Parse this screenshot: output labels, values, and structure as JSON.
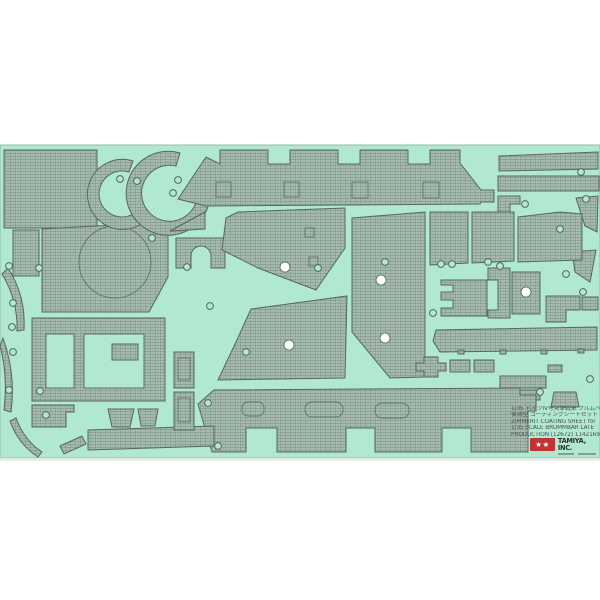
{
  "label": {
    "lines": [
      "1/35 ドイツIV号突撃戦車 ブルムベア",
      "後期型 コーティングシートセット",
      "ZIMMERIT COATING SHEET for",
      "1/35 SCALE BRUMMBAR LATE",
      "PRODUCTION (12672) 1142169"
    ]
  },
  "brand": {
    "name": "TAMIYA, INC.",
    "stars": "★★"
  },
  "colors": {
    "background": "#ffffff",
    "sheet": "#b0e8d2",
    "sheet_edge": "#8fbcaa",
    "sheet_shadow": "#dfeae4",
    "piece_base": "#a7bdaf",
    "texture_line": "#5e7366",
    "piece_stroke": "#57675c",
    "logo_red": "#c23431",
    "label_text": "#4a544e"
  },
  "sheet": {
    "x": 0,
    "y": 145,
    "w": 600,
    "h": 313,
    "pieces": [
      {
        "t": "rect",
        "x": 4,
        "y": 150,
        "w": 93,
        "h": 78,
        "name": "panel-large-left"
      },
      {
        "t": "rect",
        "x": 13,
        "y": 230,
        "w": 26,
        "h": 46,
        "name": "panel-narrow-left"
      },
      {
        "t": "poly",
        "pts": "42,229 168,222 168,277 149,312 42,312",
        "name": "turret-top-panel"
      },
      {
        "t": "circle",
        "cx": 115,
        "cy": 262,
        "r": 36,
        "cls": "scribe",
        "name": "turret-ring-scribe"
      },
      {
        "t": "path",
        "d": "M133,161 A35,35 0 1 0 150,216 L141,207 A23,23 0 1 1 129,172 Z",
        "name": "curved-arc-piece-small"
      },
      {
        "t": "path",
        "d": "M180,153 A42,42 0 1 0 208,180 L196,184 A28,28 0 1 1 176,166 Z",
        "name": "curved-arc-piece-large"
      },
      {
        "t": "path",
        "d": "M178,199 L206,157 L220,164 L220,150 L268,150 L268,164 L290,164 L290,150 L338,150 L338,164 L360,164 L360,150 L408,150 L408,164 L430,164 L430,150 L460,150 L460,163 L481,190 L494,190 L494,202 L481,202 L480,204 L206,206 Z",
        "name": "superstructure-roof-panel"
      },
      {
        "t": "rect",
        "x": 216,
        "y": 182,
        "w": 15,
        "h": 15,
        "cls": "scribe",
        "name": "hatch-scribe"
      },
      {
        "t": "rect",
        "x": 284,
        "y": 182,
        "w": 15,
        "h": 15,
        "cls": "scribe",
        "name": "hatch-scribe"
      },
      {
        "t": "rect",
        "x": 352,
        "y": 182,
        "w": 16,
        "h": 16,
        "cls": "scribe",
        "name": "hatch-scribe"
      },
      {
        "t": "rect",
        "x": 423,
        "y": 182,
        "w": 16,
        "h": 16,
        "cls": "scribe",
        "name": "hatch-scribe"
      },
      {
        "t": "poly",
        "pts": "499,156 598,152 598,169 499,171",
        "name": "long-strip-top-1"
      },
      {
        "t": "rect",
        "x": 498,
        "y": 176,
        "w": 101,
        "h": 15,
        "name": "long-strip-top-2"
      },
      {
        "t": "path",
        "d": "M498,196 h22 v8 h-10 v9 h-12 z",
        "name": "hook-piece"
      },
      {
        "t": "poly",
        "pts": "576,198 598,196 597,232 585,226",
        "name": "wedge-right-upper"
      },
      {
        "t": "poly",
        "pts": "572,252 596,250 590,282 575,272",
        "name": "wedge-right-lower"
      },
      {
        "t": "poly",
        "pts": "170,231 205,212 205,229",
        "name": "triangle-small"
      },
      {
        "t": "path",
        "d": "M176,238 h49 v30 h-14 v-12 a10,10 0 0 0 -20,0 v12 h-15 z",
        "name": "arch-panel"
      },
      {
        "t": "poly",
        "pts": "238,212 345,208 345,248 316,290 258,268 222,250 226,218",
        "name": "side-panel-left"
      },
      {
        "t": "rect",
        "x": 305,
        "y": 228,
        "w": 9,
        "h": 9,
        "cls": "scribe",
        "name": "port-scribe"
      },
      {
        "t": "rect",
        "x": 309,
        "y": 257,
        "w": 9,
        "h": 9,
        "cls": "scribe",
        "name": "port-scribe"
      },
      {
        "t": "poly",
        "pts": "352,218 425,212 425,377 390,378 352,332",
        "name": "side-panel-center"
      },
      {
        "t": "poly",
        "pts": "430,212 468,212 468,263 430,265",
        "name": "fender-panel-1"
      },
      {
        "t": "poly",
        "pts": "472,212 514,212 514,261 472,263",
        "name": "fender-panel-2"
      },
      {
        "t": "poly",
        "pts": "518,217 560,212 582,214 582,260 518,262",
        "name": "side-panel-right"
      },
      {
        "t": "path",
        "d": "M441,280 h46 v36 h-46 v-8 h12 v-8 h-12 v-8 h12 v-7 h-12 z",
        "name": "bracket-piece-1"
      },
      {
        "t": "path",
        "d": "M488,268 h22 v50 h-22 v-8 h10 v-30 h-10 z",
        "name": "bracket-piece-2"
      },
      {
        "t": "rect",
        "x": 512,
        "y": 272,
        "w": 28,
        "h": 42,
        "name": "holed-panel"
      },
      {
        "t": "path",
        "d": "M546,296 h34 v14 h-14 v12 h-20 z",
        "name": "l-shaped-piece"
      },
      {
        "t": "rect",
        "x": 582,
        "y": 297,
        "w": 16,
        "h": 13,
        "name": "small-rect-right"
      },
      {
        "t": "poly",
        "pts": "436,330 597,327 597,350 440,352 433,341",
        "name": "fender-long-right"
      },
      {
        "t": "rect",
        "x": 458,
        "y": 350,
        "w": 6,
        "h": 4,
        "name": "fender-tab"
      },
      {
        "t": "rect",
        "x": 500,
        "y": 350,
        "w": 6,
        "h": 4,
        "name": "fender-tab"
      },
      {
        "t": "rect",
        "x": 541,
        "y": 350,
        "w": 6,
        "h": 4,
        "name": "fender-tab"
      },
      {
        "t": "rect",
        "x": 578,
        "y": 349,
        "w": 6,
        "h": 4,
        "name": "fender-tab"
      },
      {
        "t": "rect",
        "x": 450,
        "y": 360,
        "w": 20,
        "h": 12,
        "name": "small-plate"
      },
      {
        "t": "rect",
        "x": 474,
        "y": 360,
        "w": 20,
        "h": 12,
        "name": "small-plate"
      },
      {
        "t": "rect",
        "x": 500,
        "y": 376,
        "w": 46,
        "h": 12,
        "name": "bar-right-a"
      },
      {
        "t": "rect",
        "x": 498,
        "y": 390,
        "w": 42,
        "h": 10,
        "name": "bar-right-b"
      },
      {
        "t": "rect",
        "x": 548,
        "y": 365,
        "w": 14,
        "h": 7,
        "name": "tiny-bar"
      },
      {
        "t": "poly",
        "pts": "554,392 576,392 579,407 551,407",
        "name": "trapezoid-right"
      },
      {
        "t": "path",
        "d": "M424,357 h14 v6 h8 v8 h-8 v6 h-14 v-6 h-8 v-8 h8 z",
        "name": "cross-piece"
      },
      {
        "t": "poly",
        "pts": "251,309 347,296 345,378 218,380 236,342",
        "name": "glacis-panel"
      },
      {
        "t": "path",
        "d": "M198,404 L214,390 L520,388 L520,395 L536,395 L536,411 L528,411 L528,452 L471,452 L471,428 L442,428 L442,452 L375,452 L375,428 L346,428 L346,452 L277,452 L277,428 L246,428 L246,452 L212,452 Z",
        "name": "hull-side-panel"
      },
      {
        "t": "rect",
        "x": 242,
        "y": 402,
        "w": 22,
        "h": 14,
        "rx": 6,
        "cls": "scribe",
        "name": "suspension-scribe"
      },
      {
        "t": "rect",
        "x": 305,
        "y": 402,
        "w": 38,
        "h": 15,
        "rx": 7,
        "cls": "scribe",
        "name": "suspension-scribe"
      },
      {
        "t": "rect",
        "x": 375,
        "y": 403,
        "w": 34,
        "h": 15,
        "rx": 7,
        "cls": "scribe",
        "name": "suspension-scribe"
      },
      {
        "t": "poly",
        "pts": "88,430 214,426 214,446 88,450",
        "name": "fender-long-left"
      },
      {
        "t": "rect",
        "x": 32,
        "y": 318,
        "w": 133,
        "h": 83,
        "name": "frame-panel"
      },
      {
        "t": "rect",
        "x": 46,
        "y": 334,
        "w": 28,
        "h": 54,
        "cls": "window",
        "name": "frame-window"
      },
      {
        "t": "rect",
        "x": 84,
        "y": 334,
        "w": 60,
        "h": 54,
        "cls": "window",
        "name": "frame-window"
      },
      {
        "t": "rect",
        "x": 112,
        "y": 344,
        "w": 26,
        "h": 16,
        "name": "inset-plate"
      },
      {
        "t": "poly",
        "pts": "32,405 74,405 74,412 66,412 66,427 32,427",
        "name": "notched-plate"
      },
      {
        "t": "poly",
        "pts": "108,409 134,409 130,427 112,427",
        "name": "bucket-piece-1"
      },
      {
        "t": "poly",
        "pts": "138,409 158,409 155,426 141,426",
        "name": "bucket-piece-2"
      },
      {
        "t": "rect",
        "x": 174,
        "y": 352,
        "w": 20,
        "h": 36,
        "name": "vertical-piece-upper"
      },
      {
        "t": "rect",
        "x": 178,
        "y": 358,
        "w": 12,
        "h": 22,
        "cls": "scribe",
        "name": "vertical-piece-scribe"
      },
      {
        "t": "rect",
        "x": 174,
        "y": 392,
        "w": 20,
        "h": 38,
        "name": "vertical-piece-lower"
      },
      {
        "t": "rect",
        "x": 178,
        "y": 398,
        "w": 12,
        "h": 24,
        "cls": "scribe",
        "name": "vertical-piece-scribe"
      },
      {
        "t": "path",
        "d": "M8,268 Q26,296 24,330 L17,331 Q18,300 2,274 Z",
        "name": "curved-strip-left-1"
      },
      {
        "t": "path",
        "d": "M3,338 Q16,374 11,412 L4,410 Q8,375 0,346 Z",
        "name": "curved-strip-left-2"
      },
      {
        "t": "path",
        "d": "M16,418 Q24,440 42,452 L38,457 Q18,444 10,421 Z",
        "name": "curved-strip-left-3"
      },
      {
        "t": "poly",
        "pts": "60,446 82,436 86,444 64,454",
        "name": "angled-strip-bottom-left"
      }
    ],
    "ring_holes": [
      [
        9,
        266
      ],
      [
        39,
        268
      ],
      [
        13,
        303
      ],
      [
        12,
        327
      ],
      [
        13,
        352
      ],
      [
        9,
        390
      ],
      [
        40,
        391
      ],
      [
        46,
        415
      ],
      [
        120,
        179
      ],
      [
        137,
        181
      ],
      [
        152,
        238
      ],
      [
        178,
        180
      ],
      [
        173,
        193
      ],
      [
        187,
        267
      ],
      [
        210,
        306
      ],
      [
        246,
        352
      ],
      [
        318,
        268
      ],
      [
        385,
        262
      ],
      [
        433,
        313
      ],
      [
        441,
        264
      ],
      [
        452,
        264
      ],
      [
        488,
        262
      ],
      [
        500,
        266
      ],
      [
        566,
        274
      ],
      [
        583,
        292
      ],
      [
        525,
        204
      ],
      [
        581,
        172
      ],
      [
        586,
        199
      ],
      [
        560,
        229
      ],
      [
        540,
        392
      ],
      [
        590,
        379
      ],
      [
        218,
        446
      ],
      [
        208,
        403
      ]
    ],
    "white_holes": [
      [
        285,
        267
      ],
      [
        381,
        280
      ],
      [
        289,
        345
      ],
      [
        385,
        338
      ],
      [
        526,
        292
      ]
    ]
  }
}
